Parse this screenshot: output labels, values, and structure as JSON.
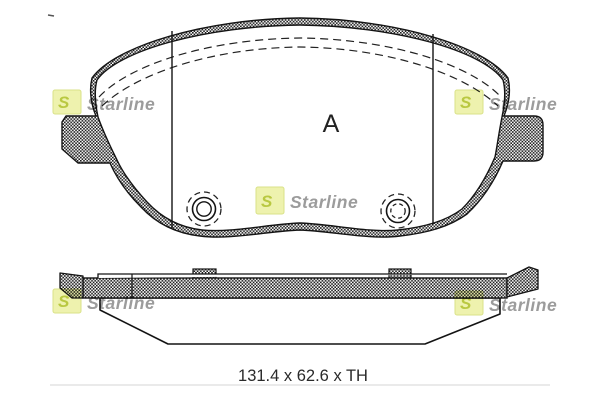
{
  "view": {
    "label": "A"
  },
  "dimension": {
    "text": "131.4 x 62.6 x TH"
  },
  "brand": {
    "name": "Starline",
    "initial": "S"
  },
  "colors": {
    "logo_box": "#eef2ae",
    "logo_border": "#dde788",
    "logo_glyph": "#b9c841",
    "watermark_text": "#9c9c9c",
    "ink": "#1c1c1c",
    "faint_line": "#dddddd"
  }
}
